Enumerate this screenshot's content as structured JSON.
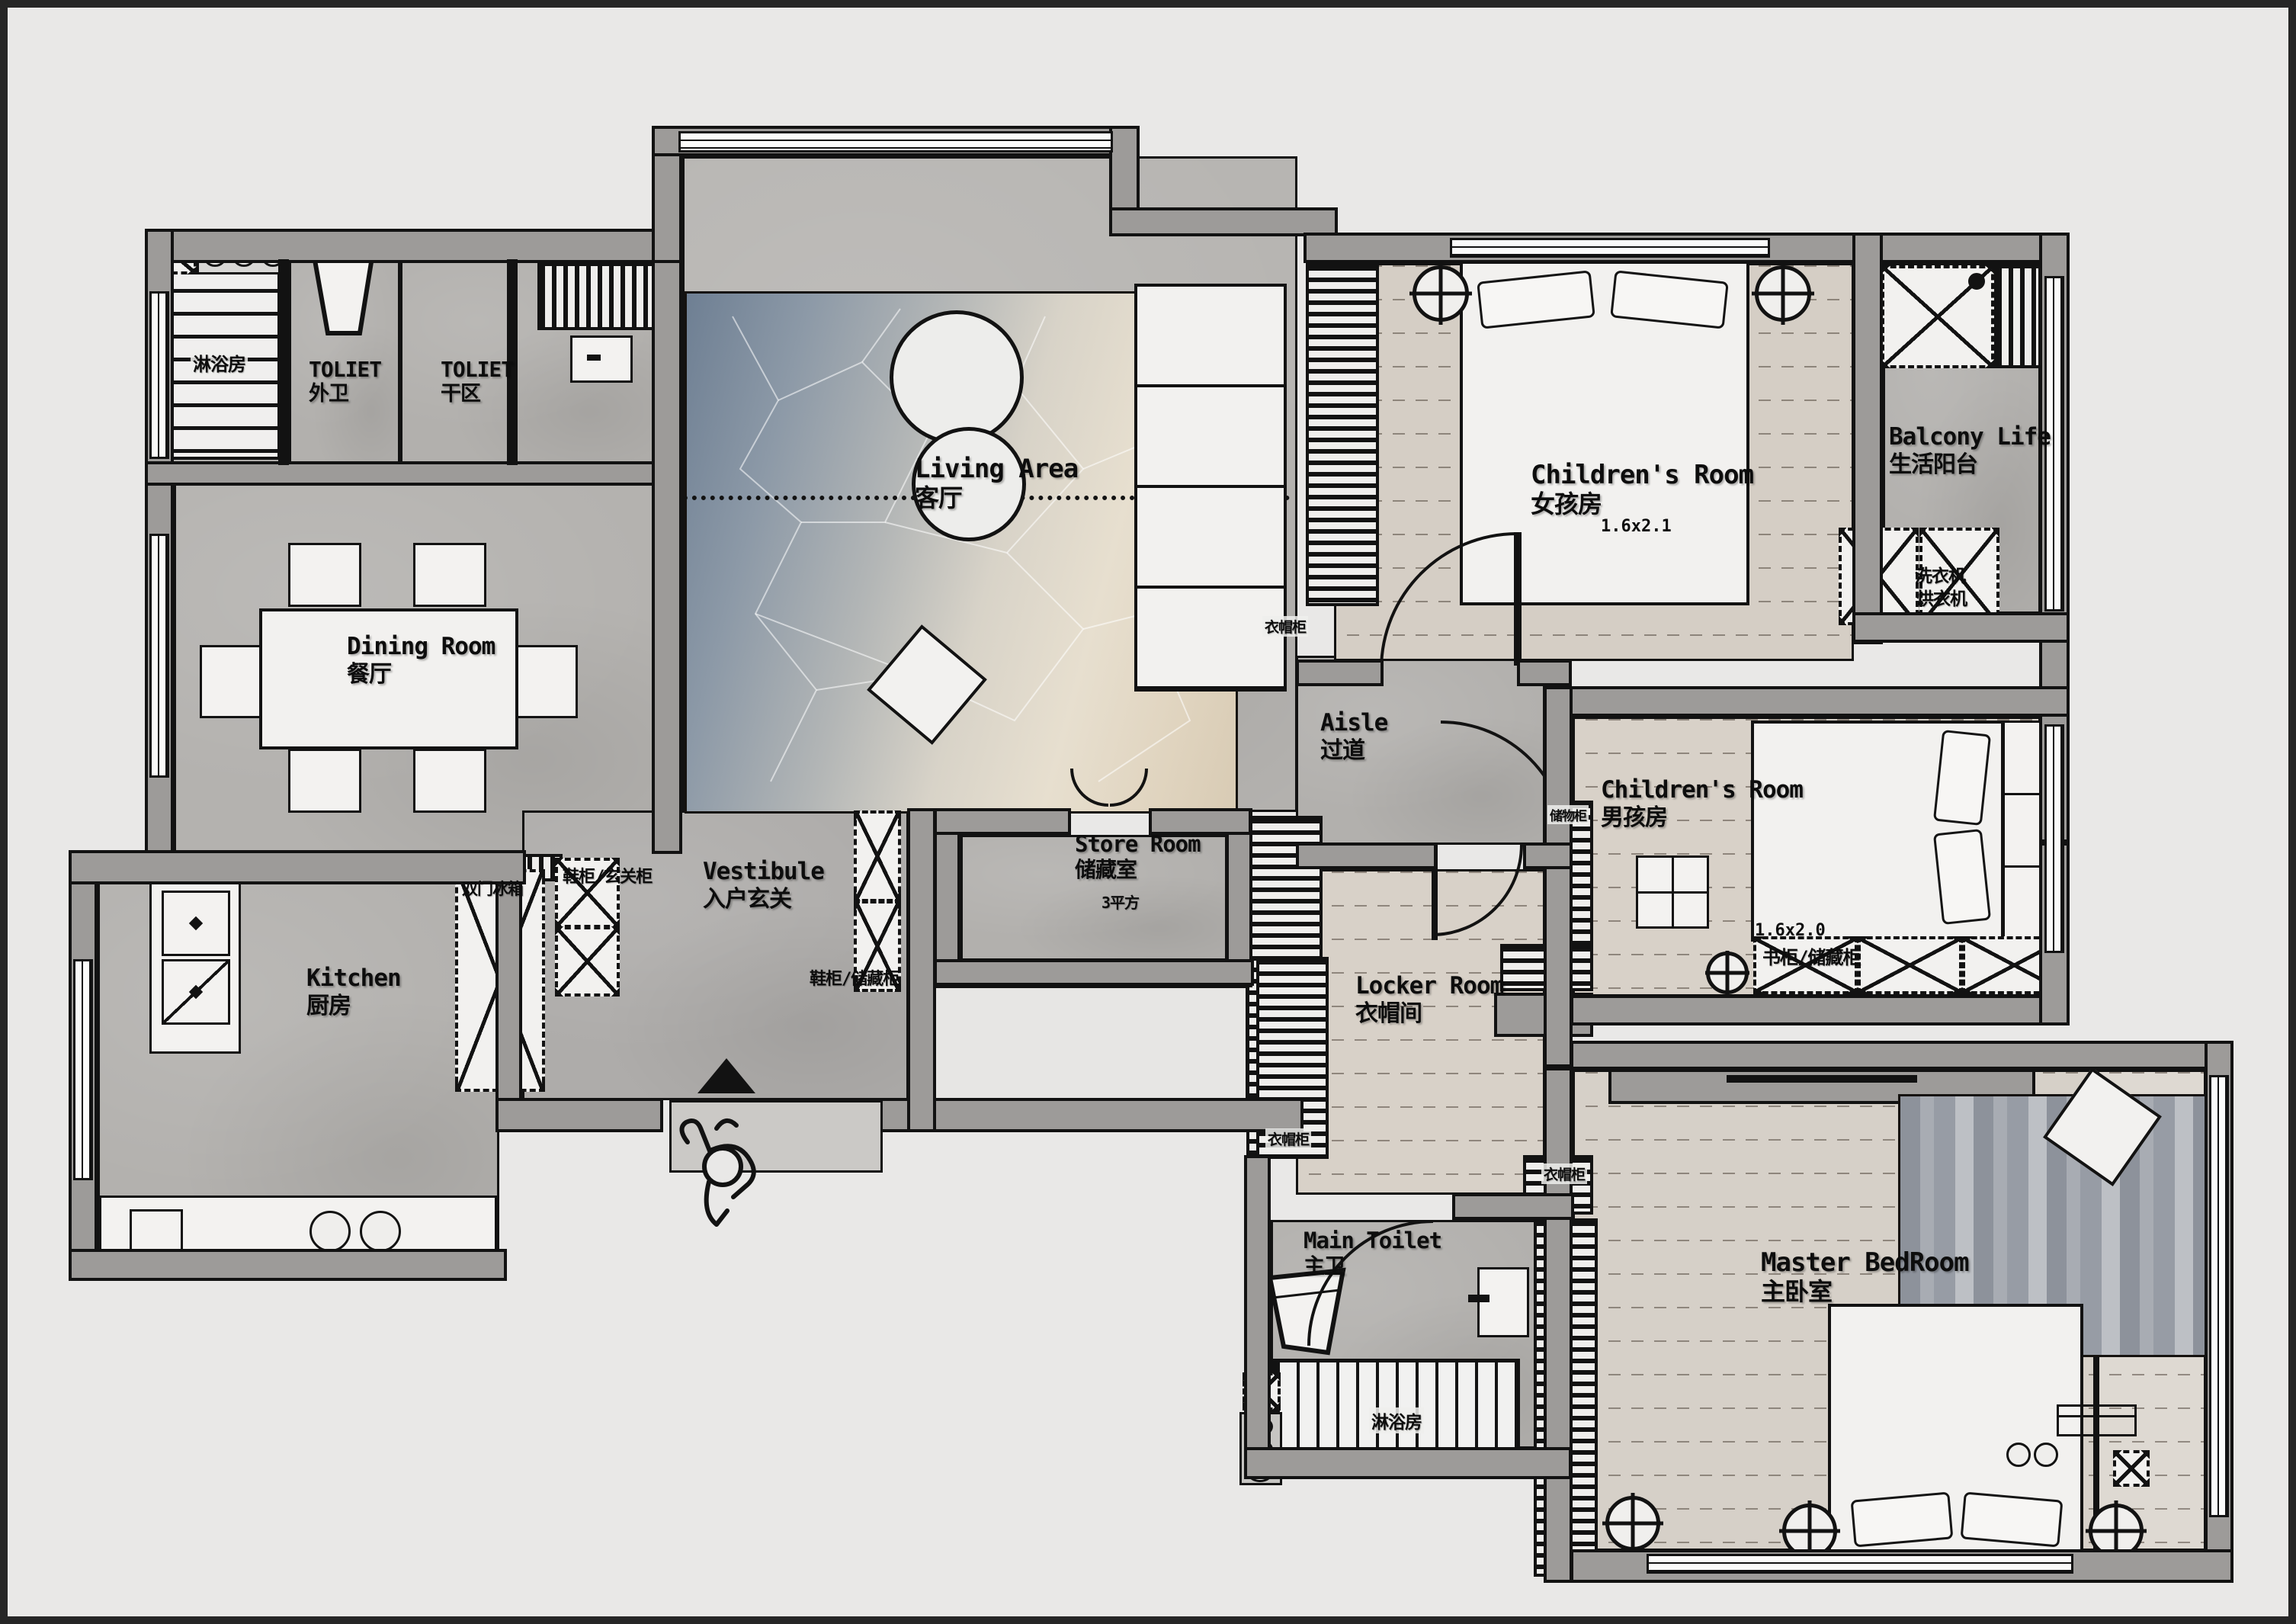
{
  "plan": {
    "type": "apartment-floor-plan",
    "colors": {
      "background": "#e9e8e7",
      "wall": "#9d9b99",
      "line": "#121212",
      "wood_girls": "#d5cec5",
      "wood_boys": "#d8d1c8",
      "wood_master": "#d6d0c8",
      "rug_blue": "#6e7f93",
      "rug_beige": "#d8cbb4",
      "concrete": "#b2b0ad"
    }
  },
  "labels": {
    "shower_top": {
      "zh": "淋浴房"
    },
    "toilet_outer": {
      "en": "TOLIET",
      "zh": "外卫"
    },
    "toilet_dry": {
      "en": "TOLIET",
      "zh": "干区"
    },
    "living": {
      "en": "Living Area",
      "zh": "客厅"
    },
    "girls": {
      "en": "Children's Room",
      "zh": "女孩房",
      "dim": "1.6x2.1"
    },
    "balcony": {
      "en": "Balcony Life",
      "zh": "生活阳台"
    },
    "washer": {
      "zh": "洗衣机"
    },
    "dryer": {
      "zh": "烘衣机"
    },
    "dining": {
      "en": "Dining Room",
      "zh": "餐厅"
    },
    "aisle": {
      "en": "Aisle",
      "zh": "过道"
    },
    "boys": {
      "en": "Children's Room",
      "zh": "男孩房",
      "dim": "1.6x2.0"
    },
    "bookcase": {
      "zh": "书柜/储藏柜"
    },
    "storage_cab": {
      "zh": "储物柜"
    },
    "vestibule": {
      "en": "Vestibule",
      "zh": "入户玄关"
    },
    "shoe_entry": {
      "zh": "鞋柜/玄关柜"
    },
    "shoe_store": {
      "zh": "鞋柜/储藏柜"
    },
    "store": {
      "en": "Store Room",
      "zh": "储藏室",
      "area": "3平方"
    },
    "kitchen": {
      "en": "Kitchen",
      "zh": "厨房"
    },
    "fridge": {
      "zh": "双门冰箱"
    },
    "locker": {
      "en": "Locker Room",
      "zh": "衣帽间"
    },
    "wardrobe1": {
      "zh": "衣帽柜"
    },
    "wardrobe2": {
      "zh": "衣帽柜"
    },
    "wardrobe3": {
      "zh": "衣帽柜"
    },
    "main_toilet": {
      "en": "Main Toilet",
      "zh": "主卫"
    },
    "master": {
      "en": "Master BedRoom",
      "zh": "主卧室"
    },
    "shower_main": {
      "zh": "淋浴房"
    }
  }
}
